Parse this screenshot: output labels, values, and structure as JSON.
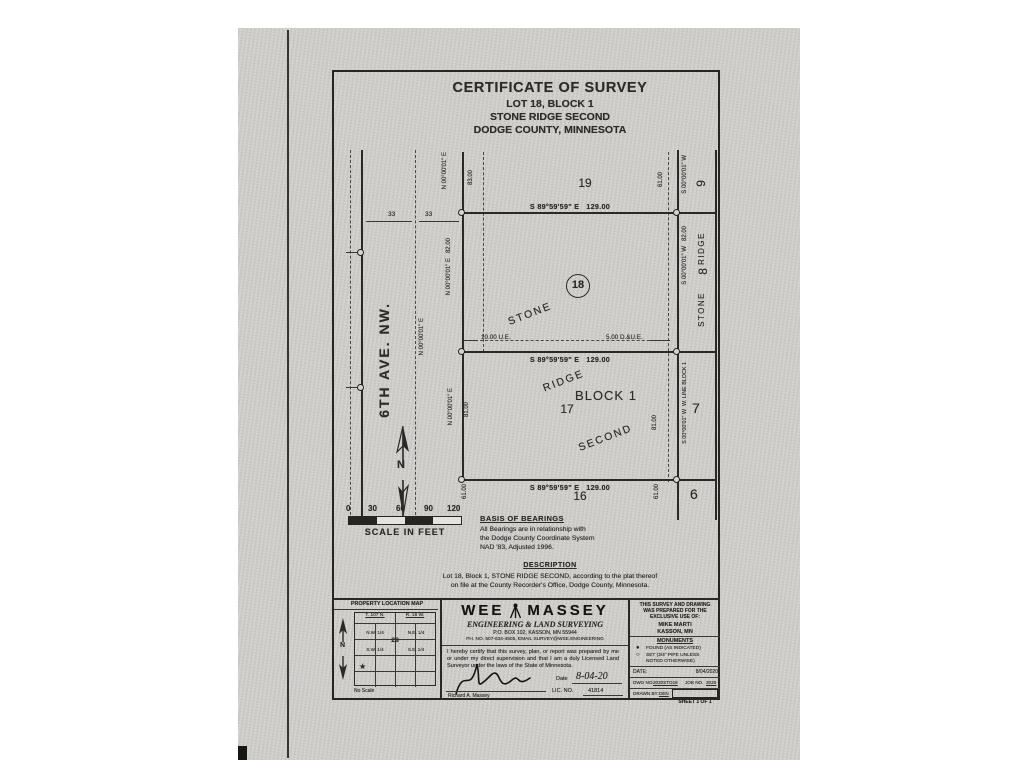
{
  "title": {
    "line1": "CERTIFICATE OF SURVEY",
    "line2": "LOT 18, BLOCK 1",
    "line3": "STONE RIDGE SECOND",
    "line4": "DODGE COUNTY, MINNESOTA"
  },
  "plat": {
    "dim_129": "S 89°59'59\" E   129.00",
    "west19_bearing": "N 00°00'01\" E",
    "west19_dim": "83.00",
    "west18": "N 00°00'01\" E   82.00",
    "west17_bearing": "N 00°00'01\" E",
    "west17_dim": "81.00",
    "west16_dim": "61.00",
    "east9_bearing": "S 00°00'01\" W",
    "east9_dim": "61.00",
    "east8": "S 00°00'01\" W   82.00",
    "east7": "S 00°00'01\" W  W. LINE BLOCK 1",
    "east7_dim": "81.00",
    "east6_dim": "61.00",
    "ue_label": "10.00 U.E.",
    "due_label": "5.00 D.&U.E.",
    "lot19": "19",
    "lot18": "18",
    "lot17": "17",
    "lot16": "16",
    "lot9": "9",
    "lot8": "8",
    "lot7": "7",
    "lot6": "6",
    "block": "BLOCK 1",
    "plat_word1": "STONE",
    "plat_word2": "RIDGE",
    "plat_word3": "SECOND",
    "adj_word1": "STONE",
    "adj_word2": "RIDGE",
    "street_name": "6TH AVE. NW.",
    "centerline_bearing": "N 00°00'01\" E",
    "half33_left": "33",
    "half33_right": "33",
    "north_letter": "N"
  },
  "scale": {
    "t0": "0",
    "t1": "30",
    "t2": "60",
    "t3": "90",
    "t4": "120",
    "caption": "SCALE IN FEET"
  },
  "basis": {
    "heading": "BASIS OF BEARINGS",
    "line1": "All Bearings are in relationship with",
    "line2": "the Dodge County Coordinate System",
    "line3": "NAD '83, Adjusted 1996."
  },
  "description": {
    "heading": "DESCRIPTION",
    "line1": "Lot 18, Block 1, STONE RIDGE SECOND, according to the plat thereof",
    "line2": "on file at the County Recorder's Office, Dodge County, Minnesota."
  },
  "titleblock": {
    "location_map": {
      "heading": "PROPERTY LOCATION MAP",
      "township": "T. 107 N.",
      "range": "R. 16 W.",
      "nw": "N.W. 1/4",
      "ne": "N.E. 1/4",
      "sw": "S.W. 1/4",
      "se": "S.E. 1/4",
      "section": "28",
      "star": "★",
      "no_scale": "No Scale",
      "north": "N"
    },
    "firm": {
      "logo_left": "WEE",
      "logo_right": "MASSEY",
      "tagline": "ENGINEERING & LAND SURVEYING",
      "address": "P.O. BOX 102, KASSON, MN 55944",
      "contact": "PH. NO. 507-634-4505, EMAIL SURVEY@WSE.ENGINEERING"
    },
    "cert": {
      "text": "I hereby certify that this survey, plan, or report was prepared by me or under my direct supervision and that I am a duly Licensed Land Surveyor under the laws of the State of Minnesota.",
      "date_label": "Date",
      "date_value": "8-04-20",
      "lic_label": "LIC. NO.",
      "lic_value": "41814",
      "signer": "Richard A. Massey"
    },
    "client": {
      "line1": "THIS SURVEY AND DRAWING",
      "line2": "WAS PREPARED FOR THE",
      "line3": "EXCLUSIVE USE OF:",
      "name": "MIKE MARTI",
      "city": "KASSON, MN"
    },
    "monuments": {
      "heading": "MONUMENTS",
      "found_symbol": "●",
      "found": "FOUND (AS INDICATED)",
      "set_symbol": "○",
      "set": "SET (3/4\" PIPE UNLESS NOTED OTHERWISE)"
    },
    "admin": {
      "date_label": "DATE:",
      "date_value": "8/04/2020",
      "dwg_label": "DWG NO.",
      "dwg_value": "2020STO18",
      "job_label": "JOB NO.",
      "job_value": "2026",
      "drawn_label": "DRAWN BY:",
      "drawn_value": "DEN",
      "sheet": "SHEET 1 OF 1"
    }
  }
}
